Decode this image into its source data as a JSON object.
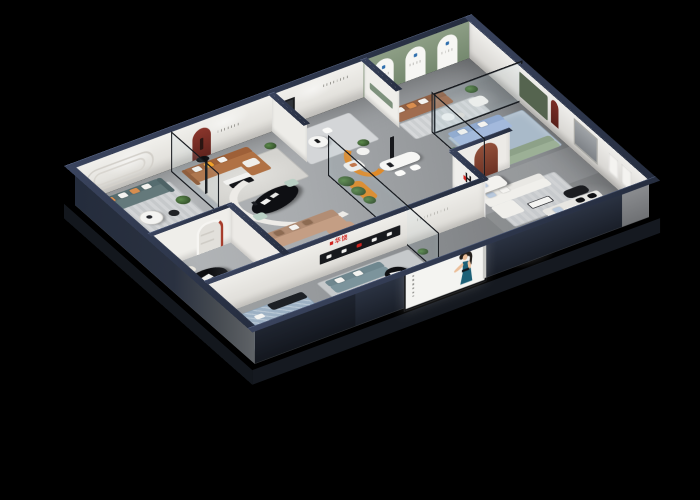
{
  "scene": {
    "type": "isometric-cutaway-showroom-render",
    "description": "3D bird's-eye cutaway of a furniture brand showroom on a black background",
    "background": "#000000"
  },
  "brand": {
    "logo_letter": "H",
    "logo_cn": "华饶",
    "logo_red": "#d0231f",
    "logo_black": "#141416"
  },
  "palette": {
    "exterior_wall": "#242c3c",
    "wall_cap": "#323b52",
    "interior_wall": "#efeeea",
    "sage_feature_wall": "#84967c",
    "maroon_niche": "#7b2e26",
    "floor_gray": "#a8abae",
    "rug_blue": "#9db1c4",
    "sofa_teal": "#64797b",
    "sofa_caramel": "#b07144",
    "sofa_brown": "#a06c4e",
    "sofa_periwinkle": "#a3b9dc",
    "sofa_sage": "#9cb096",
    "sofa_bluegray": "#7c949c",
    "sofa_tan": "#c49e84",
    "accent_orange": "#e08a28",
    "glass_frame": "#14171c"
  },
  "rooms": [
    {
      "name": "teal-lounge",
      "wall_feature": "rounded-racetrack-molding",
      "sofa_color": "#64797b"
    },
    {
      "name": "caramel-lounge",
      "wall_feature": "maroon-arch-niche-with-figurine",
      "sofa_color": "#b07144"
    },
    {
      "name": "white-dining-nook",
      "wall_feature": "black-frame-panel",
      "accent": "#e08a28"
    },
    {
      "name": "sage-arch-gallery",
      "wall_feature": "three-white-arch-boards",
      "sofa_color": "#a06c4e"
    },
    {
      "name": "glass-lounge",
      "sofa_a": "#a3b9dc",
      "sofa_b": "#9cb096",
      "feature": "cactus-terrarium"
    },
    {
      "name": "white-lounge-right",
      "wall_feature": "narrow-maroon-arch",
      "shelf": "#16181c"
    },
    {
      "name": "center-reception",
      "desk": "black-oval",
      "partition": "curved-white",
      "sectional": "#c49e84"
    },
    {
      "name": "black-marble-dining",
      "chairs": "#e9e5dc"
    },
    {
      "name": "front-blue-lounge",
      "rug": "#9db1c4",
      "console": "black-marble"
    },
    {
      "name": "front-leather-lounge",
      "sofa_color": "#7c949c",
      "table": "black-round"
    }
  ],
  "poster": {
    "subject": "model in teal halter dress",
    "dress_color": "#1d6077",
    "panel_color": "#f4f4f1"
  }
}
